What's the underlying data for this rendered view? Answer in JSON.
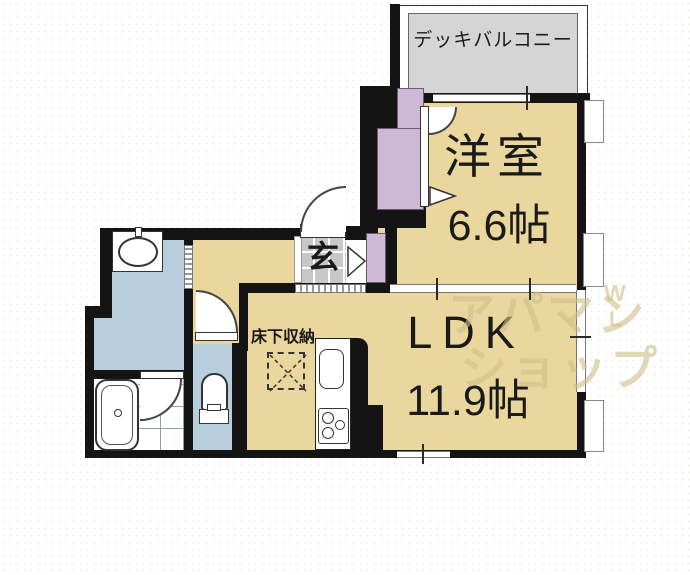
{
  "plan": {
    "balcony_label": "デッキバルコニー",
    "western_room": {
      "name": "洋室",
      "size": "6.6帖"
    },
    "ldk": {
      "name": "LDK",
      "size": "11.9帖"
    },
    "entrance_label": "玄",
    "underfloor_storage_label": "床下収納"
  },
  "watermark": {
    "line1": "アパマン",
    "line2": "ショップ",
    "side_w": "W",
    "side_l": "L"
  },
  "colors": {
    "room_tan": "#ead79d",
    "wet_area_blue": "#b9cedd",
    "closet_purple": "#cdb9d6",
    "entrance_tile_gray": "#c8c8c8",
    "balcony_gray": "#d5d5d5",
    "wall_black": "#141414",
    "watermark_tan": "#d2c08a"
  }
}
